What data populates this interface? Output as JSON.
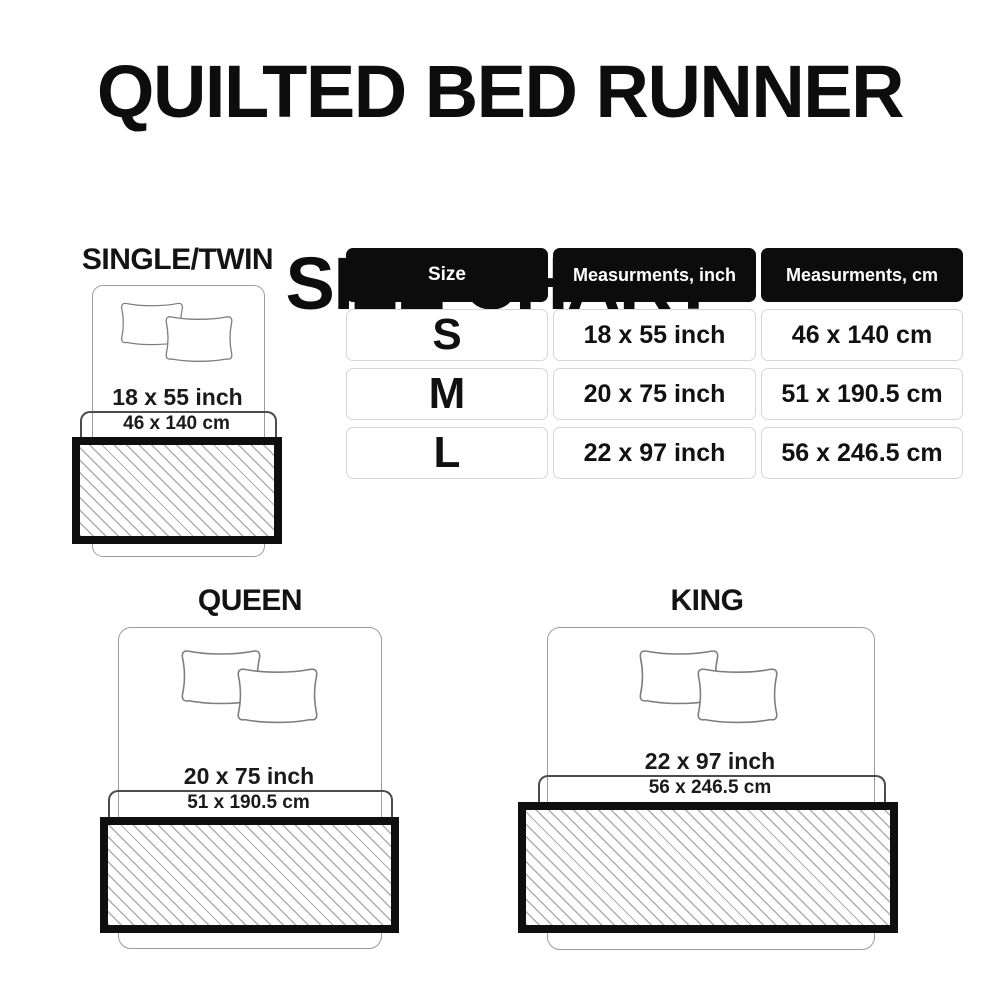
{
  "title": {
    "line1": "QUILTED BED RUNNER",
    "line2": "SIZE CHART"
  },
  "table": {
    "headers": [
      "Size",
      "Measurments, inch",
      "Measurments, cm"
    ],
    "rows": [
      {
        "size": "S",
        "inch": "18 x 55 inch",
        "cm": "46 x 140 cm"
      },
      {
        "size": "M",
        "inch": "20 x 75 inch",
        "cm": "51 x 190.5 cm"
      },
      {
        "size": "L",
        "inch": "22 x 97 inch",
        "cm": "56 x 246.5 cm"
      }
    ]
  },
  "diagrams": [
    {
      "label": "SINGLE/TWIN",
      "inch": "18 x 55 inch",
      "cm": "46 x 140 cm"
    },
    {
      "label": "QUEEN",
      "inch": "20 x 75 inch",
      "cm": "51 x 190.5 cm"
    },
    {
      "label": "KING",
      "inch": "22 x 97 inch",
      "cm": "56 x 246.5 cm"
    }
  ],
  "colors": {
    "text": "#141414",
    "table_header_bg": "#0c0c0c",
    "table_header_text": "#ffffff",
    "table_cell_border": "#d6d6d6",
    "bed_outline": "#9c9c9c",
    "bracket_line": "#4c4c4c",
    "runner_border": "#0f0f0f",
    "hatch_line": "#adadad"
  }
}
